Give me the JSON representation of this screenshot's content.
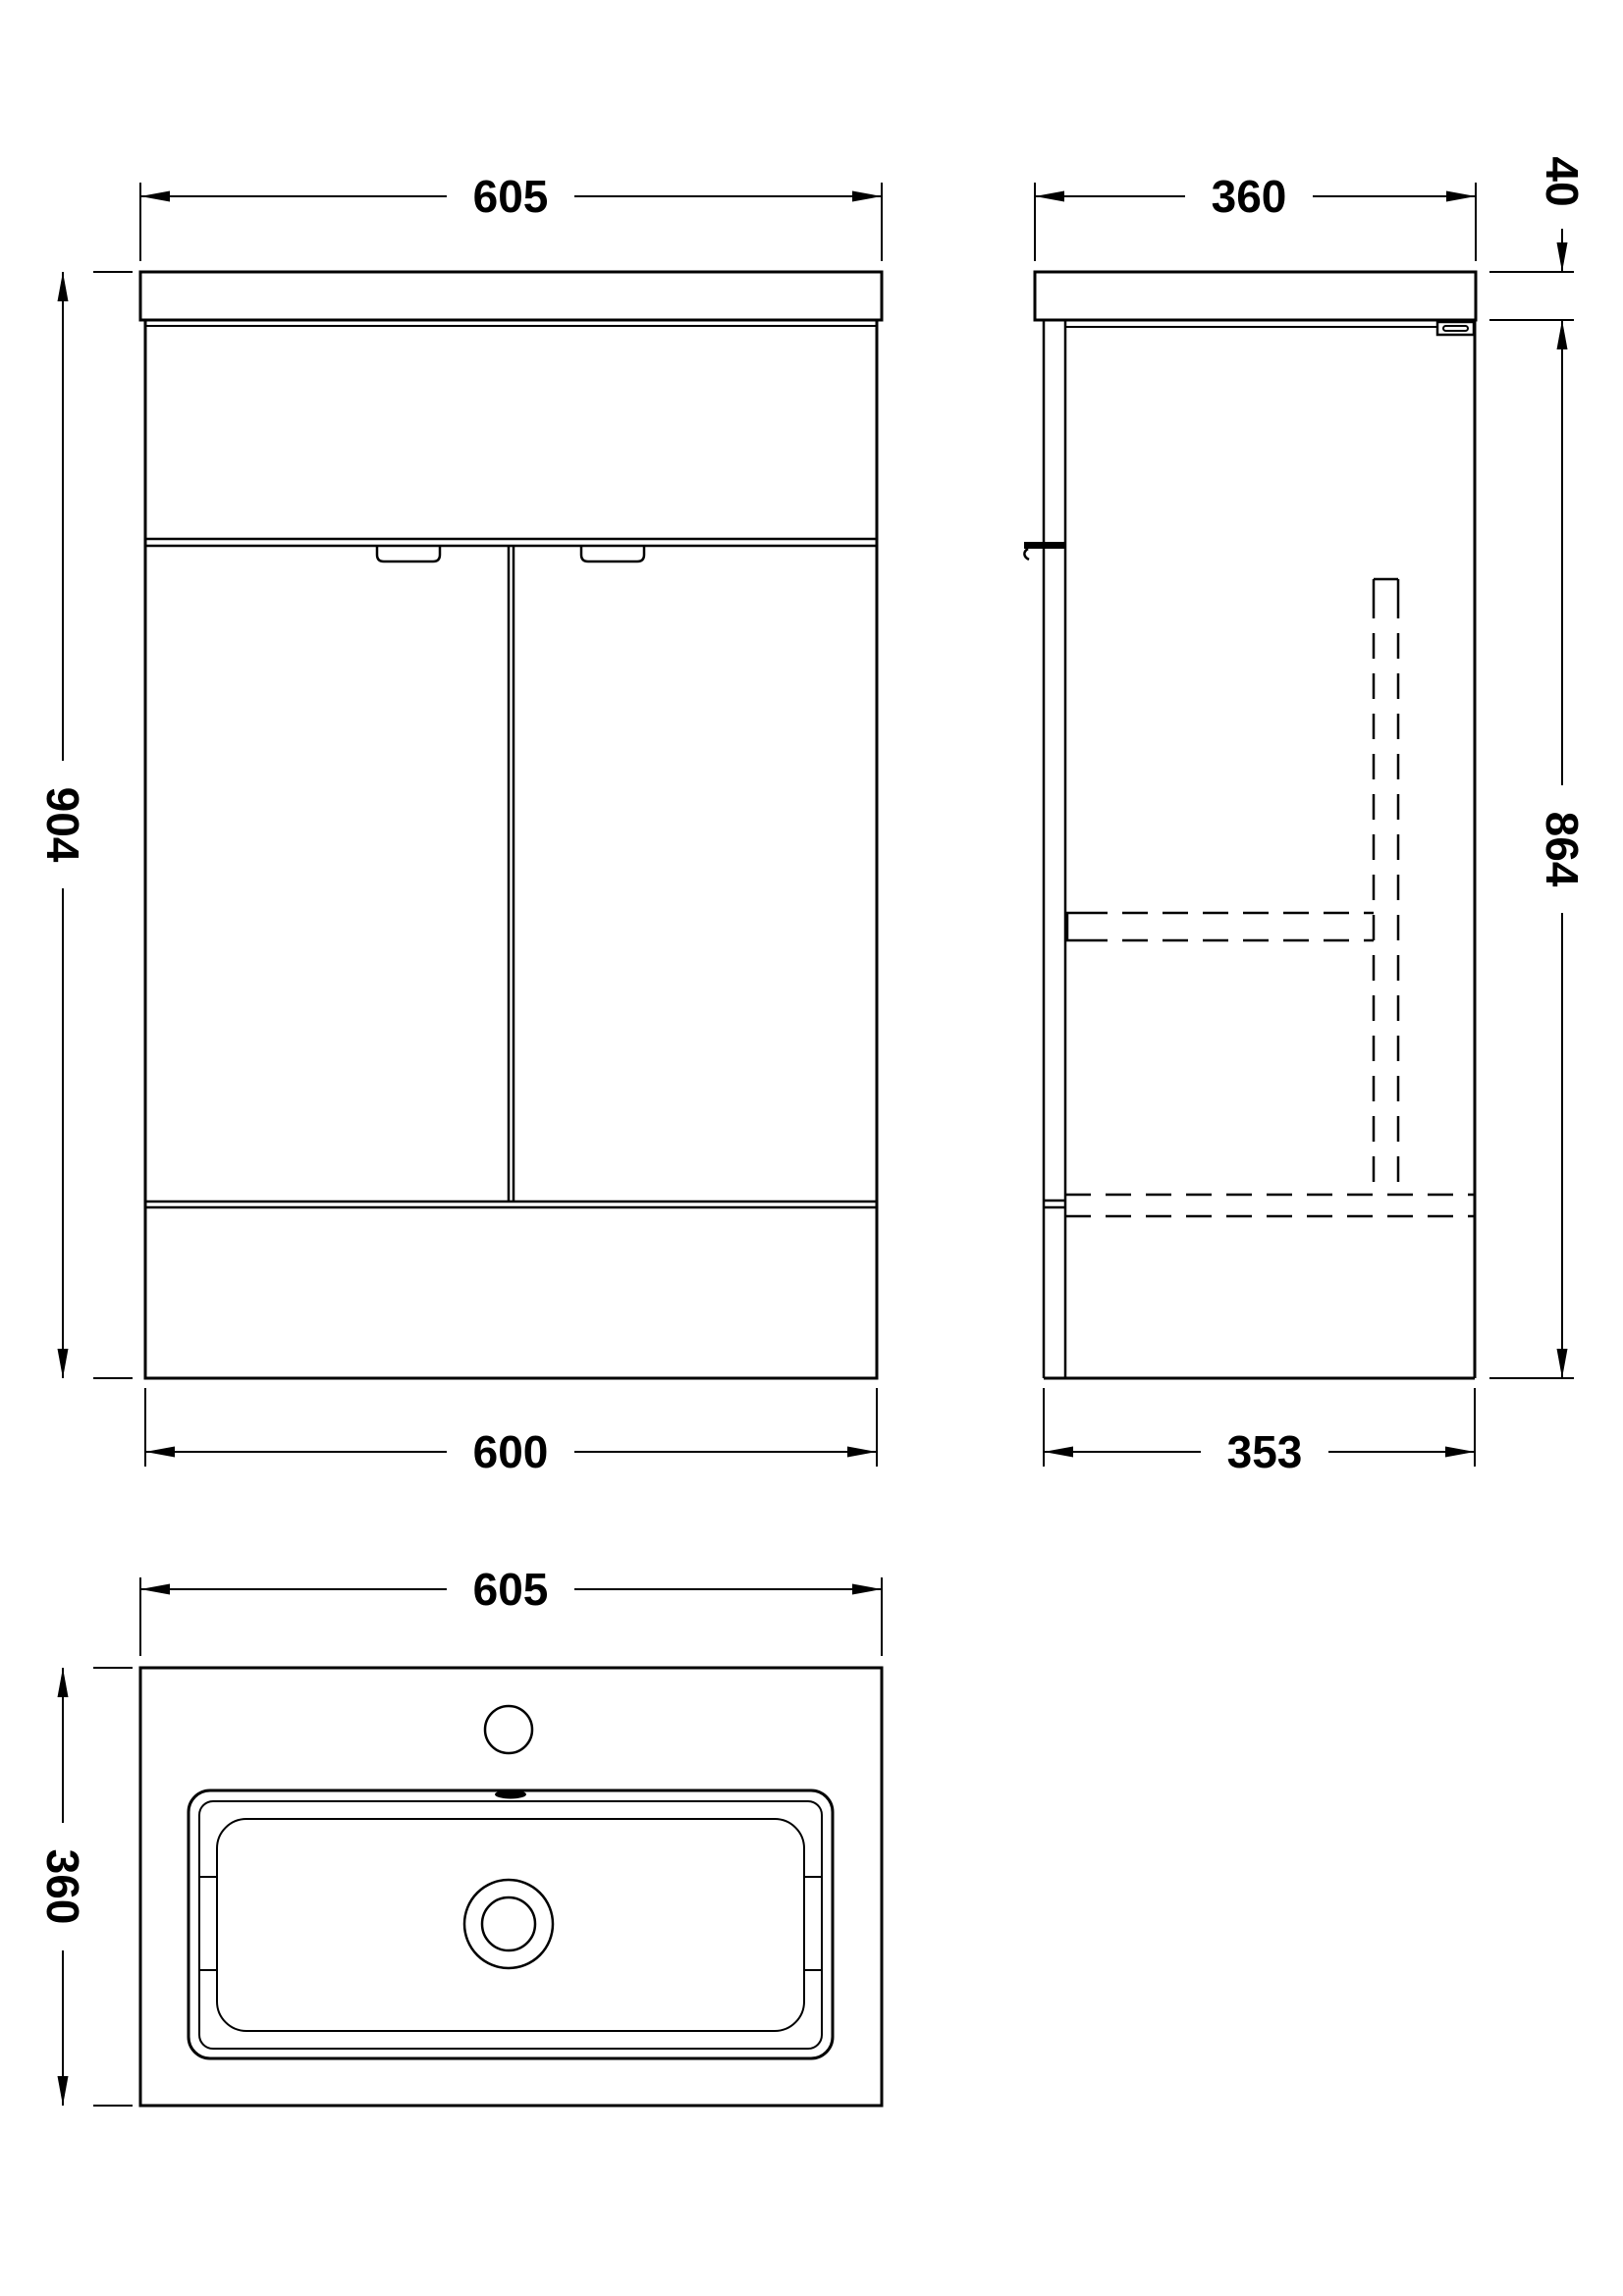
{
  "drawing": {
    "background_color": "#ffffff",
    "line_color": "#000000",
    "views": {
      "front": {
        "dim_width_top": "605",
        "dim_height": "904",
        "dim_width_bottom": "600"
      },
      "side": {
        "dim_depth_top": "360",
        "dim_counter_thickness": "40",
        "dim_body_height": "864",
        "dim_depth_bottom": "353"
      },
      "plan": {
        "dim_width": "605",
        "dim_depth": "360"
      }
    }
  }
}
